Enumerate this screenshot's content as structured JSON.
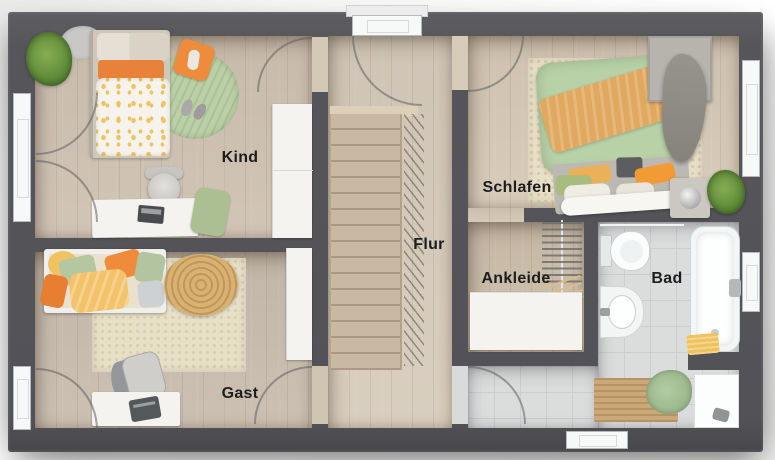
{
  "floorplan": {
    "type": "apartment-upper-floor-plan",
    "rooms": [
      {
        "id": "kind",
        "label": "Kind",
        "furniture": [
          "bed",
          "round-rug",
          "desk",
          "chair",
          "wardrobe",
          "plant"
        ]
      },
      {
        "id": "gast",
        "label": "Gast",
        "furniture": [
          "daybed",
          "rug",
          "pouf",
          "armchair",
          "console",
          "wardrobe"
        ]
      },
      {
        "id": "flur",
        "label": "Flur",
        "furniture": [
          "staircase",
          "balcony-door"
        ]
      },
      {
        "id": "schlafen",
        "label": "Schlafen",
        "furniture": [
          "double-bed",
          "rug",
          "wardrobe",
          "nightstand-lamp",
          "plant"
        ]
      },
      {
        "id": "ankleide",
        "label": "Ankleide",
        "furniture": [
          "clothes-rail",
          "dresser"
        ]
      },
      {
        "id": "bad",
        "label": "Bad",
        "furniture": [
          "toilet",
          "sink",
          "bathtub",
          "shower",
          "bath-rug",
          "towel-rail"
        ]
      }
    ],
    "palette": {
      "wall": "#55555a",
      "wood_floor": "#d2c5b2",
      "tile_floor": "#dbdddd",
      "accent_orange": "#ee8c3c",
      "accent_green": "#b5c9a2",
      "accent_yellow": "#f2c45e",
      "rug_cream": "#e9e0c8",
      "fixture_white": "#f8f9f9"
    }
  }
}
